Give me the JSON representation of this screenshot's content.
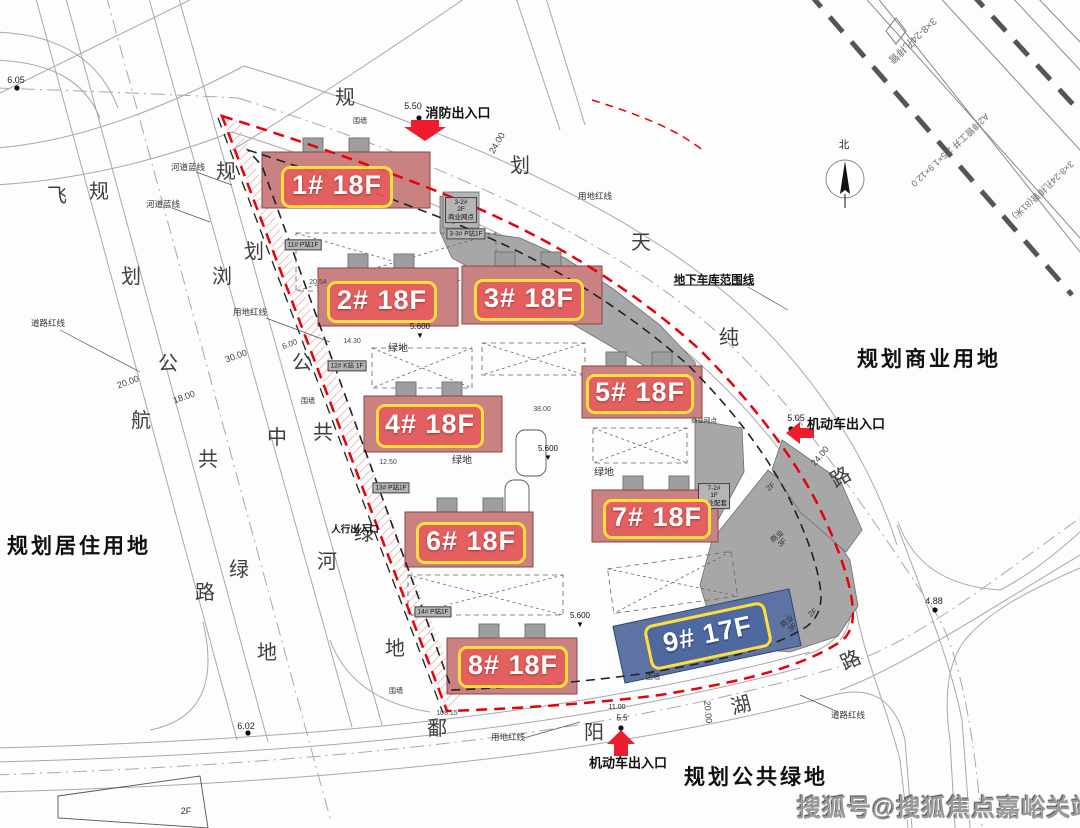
{
  "title": "住宅小区规划总平面图",
  "colors": {
    "boundary_red": "#e8000a",
    "arrow_red": "#ee1c2e",
    "badge_fill": "rgba(231,92,92,0.9)",
    "badge_border": "#ffdf3d",
    "badge_blue": "rgba(77,104,160,0.95)",
    "building_red": "#c98181",
    "building_blue": "#5d73a3",
    "gray_building": "#a7a7a7",
    "line_gray": "#a8a8a8"
  },
  "watermark": {
    "text": "搜狐号@搜狐焦点嘉峪关站"
  },
  "north": {
    "label": "北"
  },
  "badges": [
    {
      "id": "1",
      "label": "1# 18F",
      "x": 337,
      "y": 187,
      "w": 106,
      "h": 36
    },
    {
      "id": "2",
      "label": "2# 18F",
      "x": 382,
      "y": 302,
      "w": 104,
      "h": 36
    },
    {
      "id": "3",
      "label": "3# 18F",
      "x": 529,
      "y": 300,
      "w": 104,
      "h": 36
    },
    {
      "id": "4",
      "label": "4# 18F",
      "x": 430,
      "y": 426,
      "w": 102,
      "h": 38
    },
    {
      "id": "5",
      "label": "5# 18F",
      "x": 640,
      "y": 394,
      "w": 102,
      "h": 34
    },
    {
      "id": "6",
      "label": "6# 18F",
      "x": 471,
      "y": 543,
      "w": 104,
      "h": 36
    },
    {
      "id": "7",
      "label": "7# 18F",
      "x": 657,
      "y": 519,
      "w": 102,
      "h": 34
    },
    {
      "id": "8",
      "label": "8# 18F",
      "x": 513,
      "y": 667,
      "w": 104,
      "h": 36
    },
    {
      "id": "9",
      "label": "9# 17F",
      "x": 708,
      "y": 636,
      "w": 118,
      "h": 40,
      "r": -12,
      "style": "blue"
    }
  ],
  "texts": [
    {
      "t": "飞",
      "x": 57,
      "y": 196,
      "cls": "rc"
    },
    {
      "t": "规",
      "x": 99,
      "y": 192,
      "cls": "rc"
    },
    {
      "t": "划",
      "x": 131,
      "y": 277,
      "cls": "rc"
    },
    {
      "t": "公",
      "x": 168,
      "y": 364,
      "cls": "rc"
    },
    {
      "t": "共",
      "x": 208,
      "y": 460,
      "cls": "rc"
    },
    {
      "t": "绿",
      "x": 239,
      "y": 570,
      "cls": "rc"
    },
    {
      "t": "路",
      "x": 205,
      "y": 593,
      "cls": "rc"
    },
    {
      "t": "地",
      "x": 267,
      "y": 653,
      "cls": "rc"
    },
    {
      "t": "航",
      "x": 141,
      "y": 421,
      "cls": "rc"
    },
    {
      "t": "规",
      "x": 226,
      "y": 172,
      "cls": "rc"
    },
    {
      "t": "划",
      "x": 254,
      "y": 252,
      "cls": "rc"
    },
    {
      "t": "浏",
      "x": 222,
      "y": 277,
      "cls": "rc"
    },
    {
      "t": "公",
      "x": 302,
      "y": 363,
      "cls": "rc"
    },
    {
      "t": "中",
      "x": 277,
      "y": 438,
      "cls": "rc"
    },
    {
      "t": "共",
      "x": 323,
      "y": 433,
      "cls": "rc"
    },
    {
      "t": "绿",
      "x": 364,
      "y": 534,
      "cls": "rc"
    },
    {
      "t": "河",
      "x": 327,
      "y": 562,
      "cls": "rc"
    },
    {
      "t": "地",
      "x": 395,
      "y": 649,
      "cls": "rc"
    },
    {
      "t": "鄱",
      "x": 437,
      "y": 729,
      "cls": "rc"
    },
    {
      "t": "阳",
      "x": 594,
      "y": 733,
      "cls": "rc"
    },
    {
      "t": "湖",
      "x": 741,
      "y": 706,
      "cls": "rc",
      "r": -15
    },
    {
      "t": "路",
      "x": 851,
      "y": 661,
      "cls": "rc",
      "r": -25
    },
    {
      "t": "规",
      "x": 345,
      "y": 98,
      "cls": "rc"
    },
    {
      "t": "划",
      "x": 520,
      "y": 166,
      "cls": "rc"
    },
    {
      "t": "天",
      "x": 641,
      "y": 243,
      "cls": "rc"
    },
    {
      "t": "纯",
      "x": 729,
      "y": 338,
      "cls": "rc"
    },
    {
      "t": "路",
      "x": 841,
      "y": 478,
      "cls": "rc",
      "r": -30
    },
    {
      "t": "规划居住用地",
      "x": 79,
      "y": 547,
      "cls": "big",
      "name": "label-planned-residential"
    },
    {
      "t": "规划商业用地",
      "x": 929,
      "y": 360,
      "cls": "big",
      "name": "label-planned-commercial"
    },
    {
      "t": "规划公共绿地",
      "x": 756,
      "y": 778,
      "cls": "big",
      "name": "label-planned-green"
    },
    {
      "t": "消防出入口",
      "x": 458,
      "y": 114,
      "cls": "lbl",
      "name": "fire-exit-label"
    },
    {
      "t": "机动车出入口",
      "x": 846,
      "y": 425,
      "cls": "lbl",
      "name": "vehicle-entrance-east-label"
    },
    {
      "t": "机动车出入口",
      "x": 628,
      "y": 764,
      "cls": "lbl",
      "name": "vehicle-entrance-south-label"
    },
    {
      "t": "地下车库范围线",
      "x": 714,
      "y": 281,
      "cls": "lbl",
      "s": 11.5,
      "u": 1,
      "name": "garage-boundary-label"
    },
    {
      "t": "人行出入口",
      "x": 355,
      "y": 531,
      "cls": "lbl",
      "s": 9.5,
      "name": "pedestrian-entrance-label"
    },
    {
      "t": "北",
      "x": 844,
      "y": 146,
      "cls": "elev",
      "s": 10.5,
      "name": "north-label"
    },
    {
      "t": "用地红线",
      "x": 250,
      "y": 313,
      "cls": "sm"
    },
    {
      "t": "用地红线",
      "x": 508,
      "y": 738,
      "cls": "sm"
    },
    {
      "t": "用地红线",
      "x": 595,
      "y": 197,
      "cls": "sm"
    },
    {
      "t": "河道蓝线",
      "x": 188,
      "y": 168,
      "cls": "sm"
    },
    {
      "t": "河道蓝线",
      "x": 163,
      "y": 205,
      "cls": "sm"
    },
    {
      "t": "道路红线",
      "x": 48,
      "y": 324,
      "cls": "sm"
    },
    {
      "t": "道路红线",
      "x": 848,
      "y": 716,
      "cls": "sm"
    },
    {
      "t": "围墙",
      "x": 360,
      "y": 122,
      "cls": "sm",
      "s": 7
    },
    {
      "t": "围墙",
      "x": 308,
      "y": 402,
      "cls": "sm",
      "s": 7
    },
    {
      "t": "围墙",
      "x": 396,
      "y": 692,
      "cls": "sm",
      "s": 7
    },
    {
      "t": "围墙",
      "x": 653,
      "y": 678,
      "cls": "sm",
      "s": 7
    },
    {
      "t": "绿地",
      "x": 398,
      "y": 349,
      "cls": "sm",
      "s": 10
    },
    {
      "t": "绿地",
      "x": 462,
      "y": 461,
      "cls": "sm",
      "s": 10
    },
    {
      "t": "绿地",
      "x": 604,
      "y": 473,
      "cls": "sm",
      "s": 10
    },
    {
      "t": "6.05",
      "x": 16,
      "y": 80,
      "cls": "elev"
    },
    {
      "t": "6.02",
      "x": 246,
      "y": 726,
      "cls": "elev"
    },
    {
      "t": "4.88",
      "x": 934,
      "y": 601,
      "cls": "elev"
    },
    {
      "t": "5.50",
      "x": 413,
      "y": 106,
      "cls": "elev"
    },
    {
      "t": "5.05",
      "x": 796,
      "y": 418,
      "cls": "elev"
    },
    {
      "t": "5.5",
      "x": 622,
      "y": 719,
      "cls": "elev",
      "s": 8
    },
    {
      "t": "11.00",
      "x": 617,
      "y": 708,
      "cls": "elev",
      "s": 7
    },
    {
      "t": "20.00",
      "x": 128,
      "y": 382,
      "cls": "dim",
      "r": -20
    },
    {
      "t": "18.00",
      "x": 184,
      "y": 397,
      "cls": "dim",
      "r": -20
    },
    {
      "t": "30.00",
      "x": 236,
      "y": 356,
      "cls": "dim",
      "r": -20
    },
    {
      "t": "6.00",
      "x": 290,
      "y": 345,
      "cls": "dim",
      "r": -20,
      "s": 8
    },
    {
      "t": "24.00",
      "x": 497,
      "y": 143,
      "cls": "dim",
      "r": -60
    },
    {
      "t": "24.00",
      "x": 820,
      "y": 456,
      "cls": "dim",
      "r": -50
    },
    {
      "t": "20.00",
      "x": 708,
      "y": 712,
      "cls": "dim",
      "r": 85
    },
    {
      "t": "14.30",
      "x": 352,
      "y": 342,
      "cls": "dim",
      "s": 7
    },
    {
      "t": "12.50",
      "x": 388,
      "y": 463,
      "cls": "dim",
      "s": 7
    },
    {
      "t": "13.30",
      "x": 343,
      "y": 198,
      "cls": "dim",
      "s": 7
    },
    {
      "t": "20.54",
      "x": 318,
      "y": 283,
      "cls": "dim",
      "s": 7
    },
    {
      "t": "38.00",
      "x": 542,
      "y": 410,
      "cls": "dim",
      "s": 7
    },
    {
      "t": "108.15",
      "x": 447,
      "y": 714,
      "cls": "dim",
      "s": 7
    },
    {
      "t": "11# P站1F",
      "x": 303,
      "y": 245,
      "cls": "box"
    },
    {
      "t": "12# K站 1F",
      "x": 347,
      "y": 366,
      "cls": "box"
    },
    {
      "t": "13# P站1F",
      "x": 391,
      "y": 488,
      "cls": "box"
    },
    {
      "t": "14# P站1F",
      "x": 433,
      "y": 612,
      "cls": "box"
    },
    {
      "t": "3-3# P站1F",
      "x": 466,
      "y": 234,
      "cls": "box"
    },
    {
      "t": "3-2#\n2F\n商业网点",
      "x": 461,
      "y": 210,
      "cls": "box"
    },
    {
      "t": "7-2#\n1F\n商业配套",
      "x": 714,
      "y": 496,
      "cls": "box"
    },
    {
      "t": "商业\n3F",
      "x": 780,
      "y": 540,
      "cls": "tiny",
      "r": -40
    },
    {
      "t": "商业\n3F",
      "x": 790,
      "y": 625,
      "cls": "tiny",
      "r": -40
    },
    {
      "t": "2F",
      "x": 771,
      "y": 487,
      "cls": "tiny",
      "r": -40
    },
    {
      "t": "2F",
      "x": 813,
      "y": 613,
      "cls": "tiny",
      "r": -40
    },
    {
      "t": "2F",
      "x": 186,
      "y": 811,
      "cls": "tiny",
      "s": 9
    },
    {
      "t": "商业网点",
      "x": 704,
      "y": 421,
      "cls": "tiny",
      "s": 6.5
    },
    {
      "t": "3×8-24孔排管",
      "x": 912,
      "y": 40,
      "cls": "pipe",
      "r": 137
    },
    {
      "t": "A2排管工井\n2.5×1.9×12.0",
      "x": 950,
      "y": 150,
      "cls": "pipe",
      "r": 137,
      "s": 9
    },
    {
      "t": "3×8-24孔排管(81米)",
      "x": 1043,
      "y": 190,
      "cls": "pipe",
      "r": 137,
      "s": 9
    },
    {
      "t": "5.600\n▼",
      "x": 420,
      "y": 332,
      "cls": "lvl"
    },
    {
      "t": "5.600\n▼",
      "x": 548,
      "y": 454,
      "cls": "lvl"
    },
    {
      "t": "5.600\n▼",
      "x": 580,
      "y": 621,
      "cls": "lvl"
    }
  ]
}
